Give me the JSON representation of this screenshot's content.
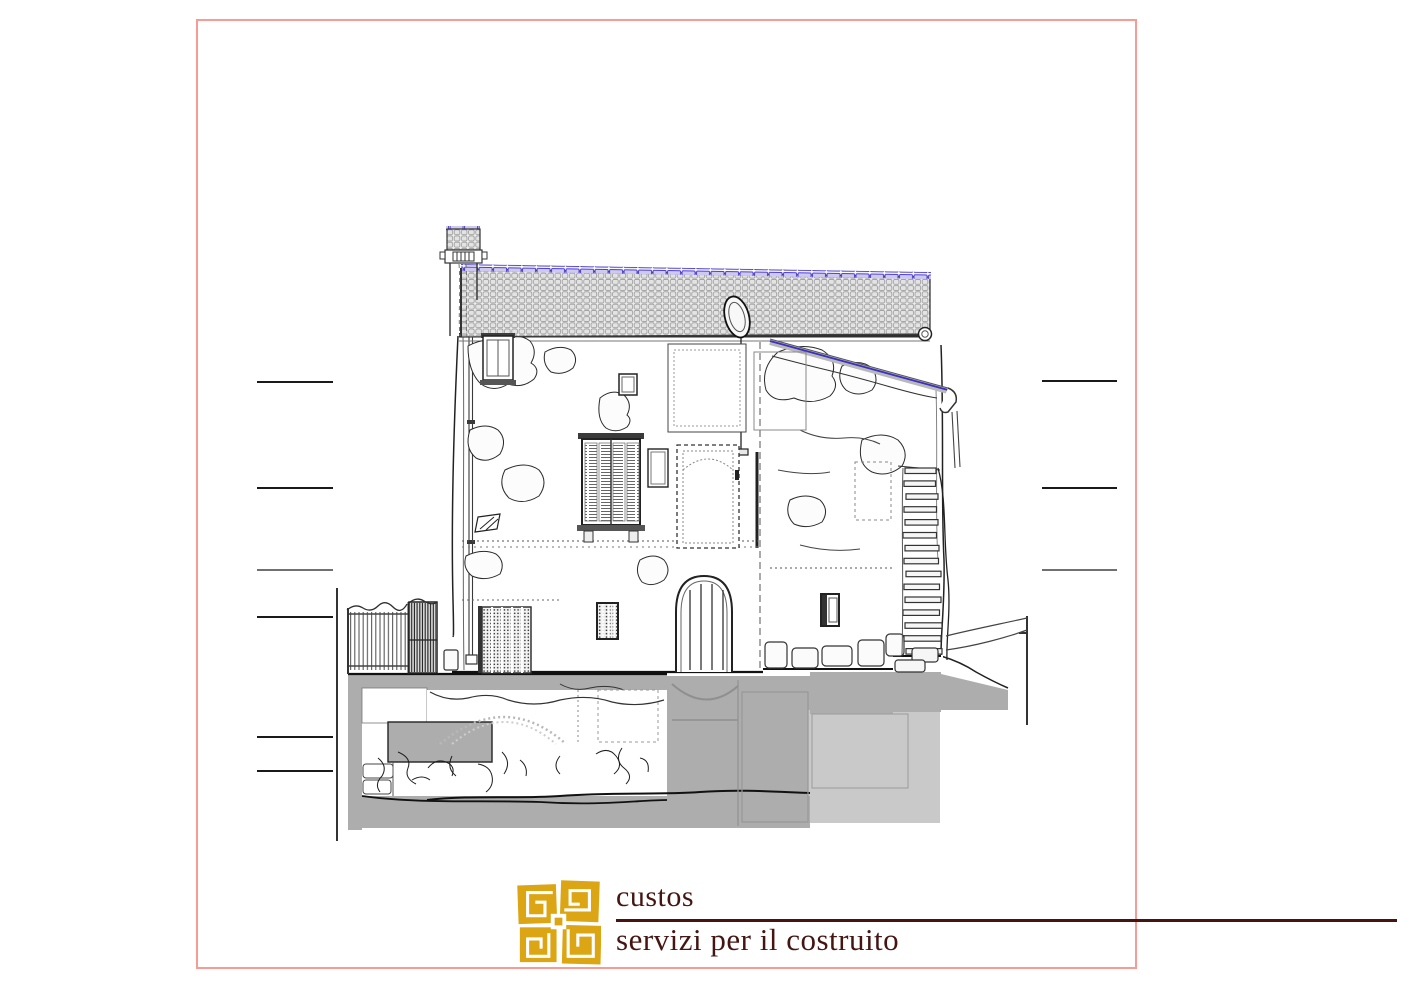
{
  "sheet": {
    "background": "#ffffff"
  },
  "colors": {
    "frame-pink": "#f89b94",
    "section-gray": "#adadad",
    "section-gray-light": "#c9c9c9",
    "ridge-blue": "#4a3dcb",
    "ridge-fill": "#cfc9f0",
    "logo-gold": "#dca514",
    "logo-maroon": "#451511",
    "ink": "#1f1f1f"
  },
  "drawing": {
    "type": "building-section-elevation-survey",
    "features": [
      "tiled roof with blue ridge",
      "chimney",
      "satellite dish",
      "shuttered window",
      "arched plank doorway",
      "external stone staircase",
      "garden fence",
      "gray underground section fill",
      "level marker lines"
    ],
    "level_markers": {
      "left": 6,
      "right": 3
    }
  },
  "logo": {
    "icon": "custos-logo",
    "title": "custos",
    "subtitle": "servizi per il costruito"
  }
}
